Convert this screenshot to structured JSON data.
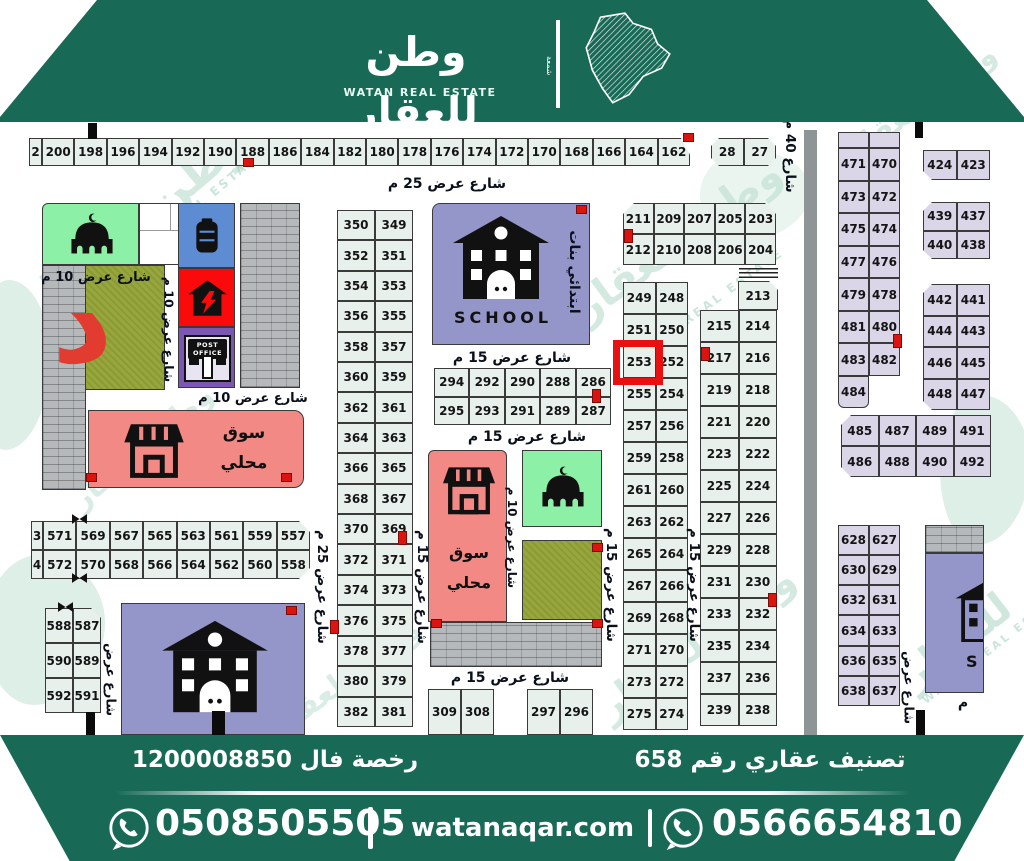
{
  "header": {
    "brand_ar": "وطن للعقار",
    "brand_en": "WATAN REAL ESTATE",
    "logo_mark": "شمعة"
  },
  "footer": {
    "classification": "تصنيف عقاري رقم 658",
    "license": "رخصة فال 1200008850",
    "phone_left": "0508505505",
    "website": "watanaqar.com",
    "phone_right": "0566654810"
  },
  "streets": {
    "w25": "شارع عرض 25 م",
    "w15": "شارع عرض 15 م",
    "w10": "شارع عرض 10 م",
    "w40": "شارع 40 م",
    "partial": "شارع عرض",
    "meem": "م"
  },
  "labels": {
    "market_l1": "سوق",
    "market_l2": "محلي",
    "school_en": "SCHOOL",
    "school_ar": "ابتدائي بنات",
    "post_office": "POST OFFICE",
    "letter_d": "د",
    "school_right_partial": "S"
  },
  "plots": {
    "top_partial": "2",
    "top_row": [
      [
        "200",
        "198",
        "196",
        "194",
        "192",
        "190",
        "188",
        "186",
        "184",
        "182",
        "180",
        "178",
        "176",
        "174",
        "172",
        "170",
        "168",
        "166",
        "164",
        "162"
      ]
    ],
    "block_28": [
      [
        "28",
        "27"
      ]
    ],
    "col_349": [
      [
        "350",
        "349"
      ],
      [
        "352",
        "351"
      ],
      [
        "354",
        "353"
      ],
      [
        "356",
        "355"
      ],
      [
        "358",
        "357"
      ],
      [
        "360",
        "359"
      ],
      [
        "362",
        "361"
      ],
      [
        "364",
        "363"
      ],
      [
        "366",
        "365"
      ],
      [
        "368",
        "367"
      ],
      [
        "370",
        "369"
      ],
      [
        "372",
        "371"
      ],
      [
        "374",
        "373"
      ],
      [
        "376",
        "375"
      ],
      [
        "378",
        "377"
      ],
      [
        "380",
        "379"
      ],
      [
        "382",
        "381"
      ]
    ],
    "grid_294": [
      [
        "294",
        "292",
        "290",
        "288",
        "286"
      ],
      [
        "295",
        "293",
        "291",
        "289",
        "287"
      ]
    ],
    "block_203": [
      [
        "211",
        "209",
        "207",
        "205",
        "203"
      ],
      [
        "212",
        "210",
        "208",
        "206",
        "204"
      ]
    ],
    "cell_213": "213",
    "col_215": [
      [
        "215",
        "214"
      ],
      [
        "217",
        "216"
      ],
      [
        "219",
        "218"
      ],
      [
        "221",
        "220"
      ],
      [
        "223",
        "222"
      ],
      [
        "225",
        "224"
      ],
      [
        "227",
        "226"
      ],
      [
        "229",
        "228"
      ],
      [
        "231",
        "230"
      ],
      [
        "233",
        "232"
      ],
      [
        "235",
        "234"
      ],
      [
        "237",
        "236"
      ],
      [
        "239",
        "238"
      ]
    ],
    "col_249": [
      [
        "249",
        "248"
      ],
      [
        "251",
        "250"
      ],
      [
        "253",
        "252"
      ],
      [
        "255",
        "254"
      ],
      [
        "257",
        "256"
      ],
      [
        "259",
        "258"
      ],
      [
        "261",
        "260"
      ],
      [
        "263",
        "262"
      ],
      [
        "265",
        "264"
      ],
      [
        "267",
        "266"
      ],
      [
        "269",
        "268"
      ],
      [
        "271",
        "270"
      ],
      [
        "273",
        "272"
      ],
      [
        "275",
        "274"
      ]
    ],
    "highlight": "253",
    "row_557_partial": [
      [
        "3"
      ],
      [
        "4"
      ]
    ],
    "row_557": [
      [
        "571",
        "569",
        "567",
        "565",
        "563",
        "561",
        "559",
        "557"
      ],
      [
        "572",
        "570",
        "568",
        "566",
        "564",
        "562",
        "560",
        "558"
      ]
    ],
    "col_587": [
      [
        "588",
        "587"
      ],
      [
        "590",
        "589"
      ],
      [
        "592",
        "591"
      ]
    ],
    "col_471": [
      [
        "471",
        "470"
      ],
      [
        "473",
        "472"
      ],
      [
        "475",
        "474"
      ],
      [
        "477",
        "476"
      ],
      [
        "479",
        "478"
      ],
      [
        "481",
        "480"
      ],
      [
        "483",
        "482"
      ]
    ],
    "cell_484": "484",
    "block_423": [
      [
        "424",
        "423"
      ]
    ],
    "block_437": [
      [
        "439",
        "437"
      ],
      [
        "440",
        "438"
      ]
    ],
    "block_441": [
      [
        "442",
        "441"
      ],
      [
        "444",
        "443"
      ],
      [
        "446",
        "445"
      ],
      [
        "448",
        "447"
      ]
    ],
    "row_485": [
      [
        "485",
        "487",
        "489",
        "491"
      ],
      [
        "486",
        "488",
        "490",
        "492"
      ]
    ],
    "col_627": [
      [
        "628",
        "627"
      ],
      [
        "630",
        "629"
      ],
      [
        "632",
        "631"
      ],
      [
        "634",
        "633"
      ],
      [
        "636",
        "635"
      ],
      [
        "638",
        "637"
      ]
    ],
    "cells_309": [
      [
        "309",
        "308"
      ]
    ],
    "cells_297": [
      [
        "297",
        "296"
      ]
    ]
  },
  "watermark": {
    "ar": "وطن للعقار",
    "en": "WATAN REAL ESTATE"
  },
  "accents": {
    "brand_green": "#186a57",
    "highlight_red": "#e81010",
    "mint": "#8df0a7",
    "salmon": "#f28984",
    "school_purple": "#9496ca",
    "cell_green": "#e8f0ec",
    "cell_purple": "#dbd5e8"
  }
}
